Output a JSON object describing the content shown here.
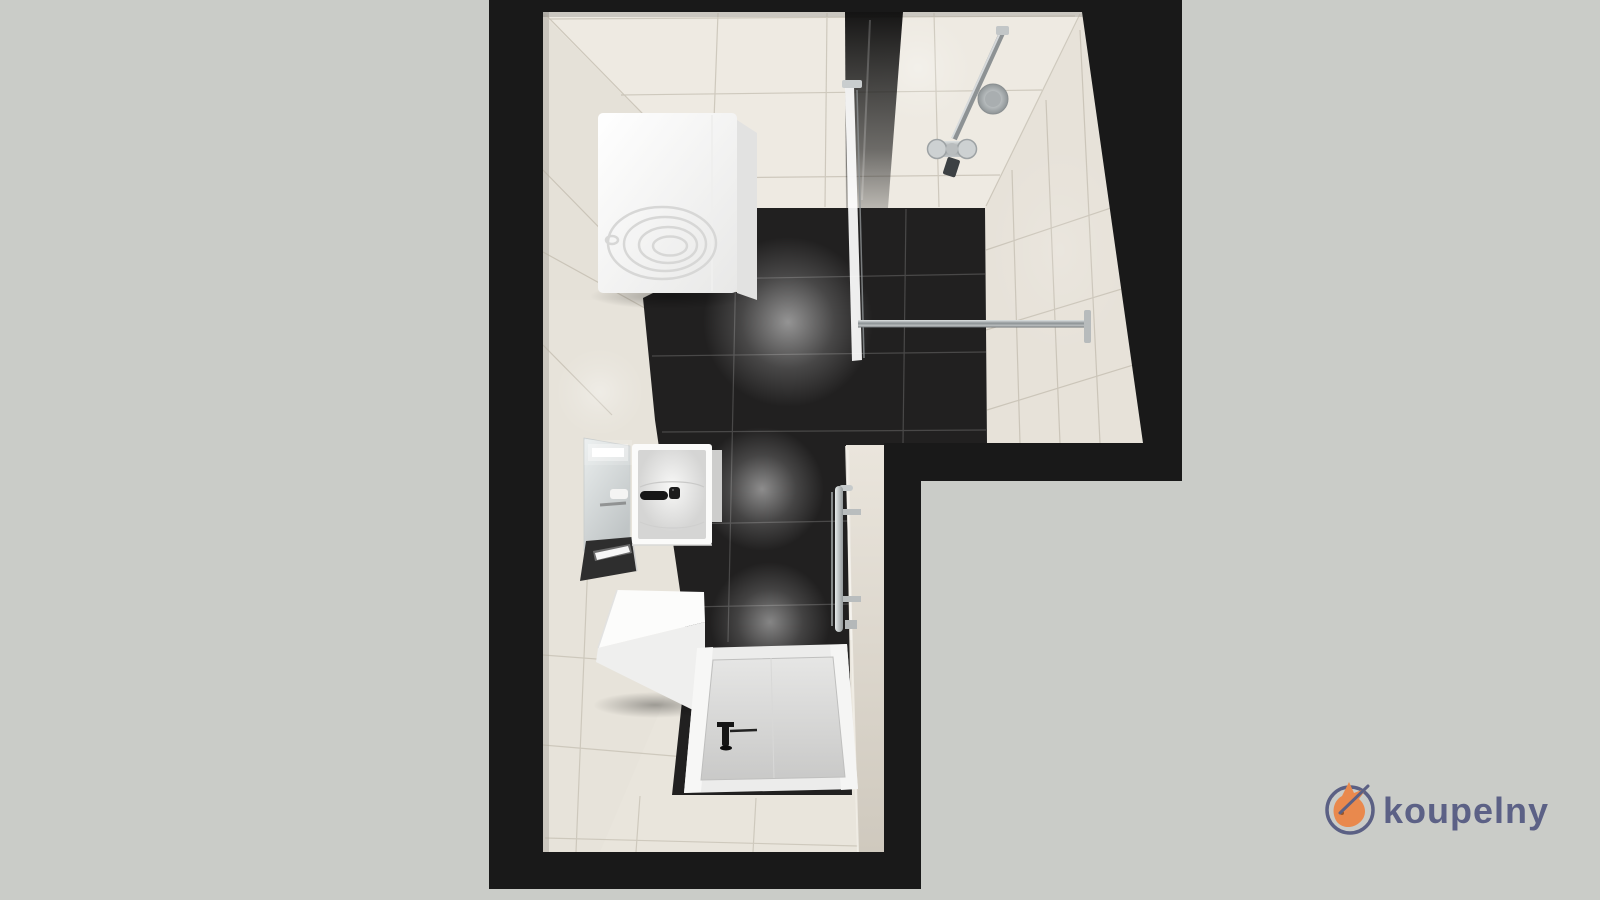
{
  "logo": {
    "label": "koupelny",
    "icon": "fox-logo-icon",
    "text_color": "#5c6186",
    "icon_color": "#e9894d",
    "ring_color": "#5b6084"
  },
  "scene": {
    "type": "l-shaped-bathroom-floorplan-3d-top-view",
    "colors": {
      "background": "#caccc8",
      "wall_cut": "#191919",
      "wall_tiles": "#e9e5dc",
      "dark_floor_tiles": "#212020",
      "fixture_white": "#fafafa",
      "chrome": "#aeb4b6"
    },
    "fixtures": [
      "washing-machine",
      "walk-in-shower-glass-panel",
      "shower-rail-hand-shower",
      "wall-shower-mixer",
      "glass-support-bar",
      "illuminated-mirror",
      "washbasin-with-cabinet",
      "black-basin-mixer",
      "storage-bench",
      "shower-tray",
      "floor-shower-mixer",
      "towel-radiator"
    ]
  }
}
